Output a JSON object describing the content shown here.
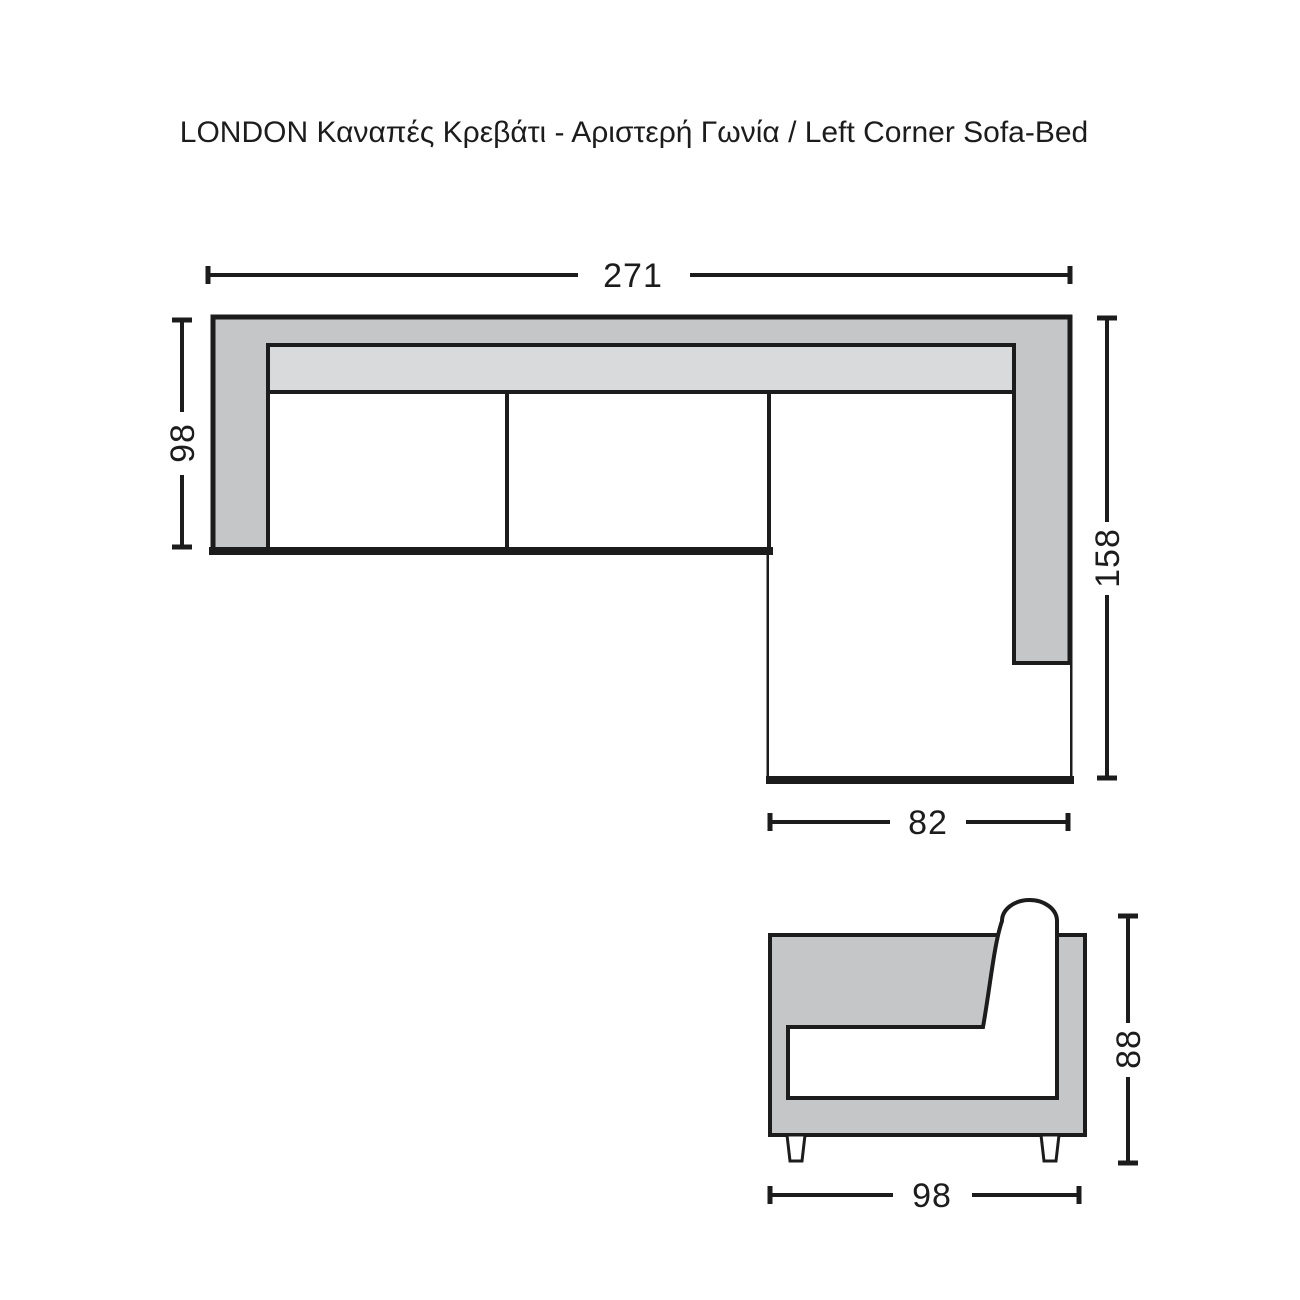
{
  "title": "LONDON Καναπές Κρεβάτι - Αριστερή Γωνία / Left Corner Sofa-Bed",
  "plan_view": {
    "dim_total_width": "271",
    "dim_left_depth": "98",
    "dim_right_length": "158",
    "dim_chaise_width": "82"
  },
  "side_view": {
    "dim_height": "88",
    "dim_depth": "98"
  },
  "colors": {
    "frame_gray": "#c5c6c8",
    "cushion_gray": "#d9dadc",
    "line_black": "#1c1c1c",
    "background": "#ffffff"
  }
}
